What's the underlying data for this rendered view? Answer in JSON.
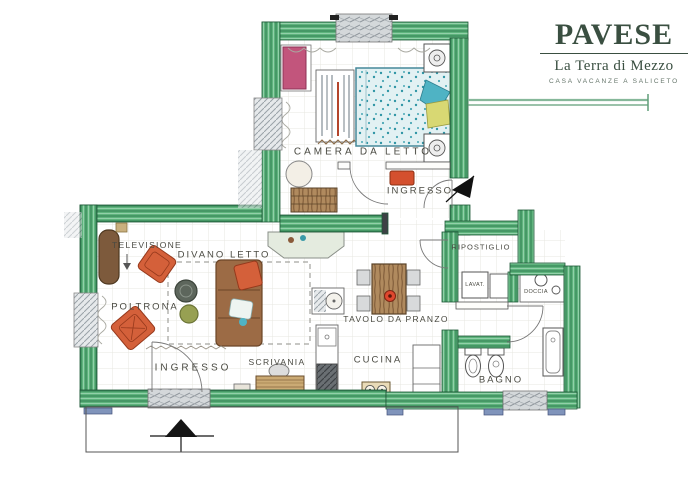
{
  "logo": {
    "brand": "PAVESE",
    "subtitle": "La Terra di Mezzo",
    "tagline": "CASA VACANZE A SALICETO"
  },
  "plan": {
    "labels": {
      "camera_da_letto": "CAMERA DA LETTO",
      "ingresso_bedroom": "INGRESSO",
      "ingresso_living": "INGRESSO",
      "televisione": "TELEVISIONE",
      "divano_letto": "DIVANO LETTO",
      "poltrona": "POLTRONA",
      "tavolo_da_pranzo": "TAVOLO DA PRANZO",
      "scrivania": "SCRIVANIA",
      "cucina": "CUCINA",
      "ripostiglio": "RIPOSTIGLIO",
      "lavatrice": "LAVAT.",
      "doccia": "DOCCIA",
      "bagno": "BAGNO"
    },
    "colors": {
      "wall_green": "#5fb47d",
      "wall_green_dark": "#2e7d4f",
      "logo_green": "#3a4f41",
      "wardrobe_pink": "#c2557c",
      "bed_teal": "#7fc4cf",
      "sofa_brown": "#9c6b45",
      "armchair_orange": "#d4603a",
      "table_wood": "#b08a5e",
      "sill_blue": "#8094bb"
    }
  }
}
